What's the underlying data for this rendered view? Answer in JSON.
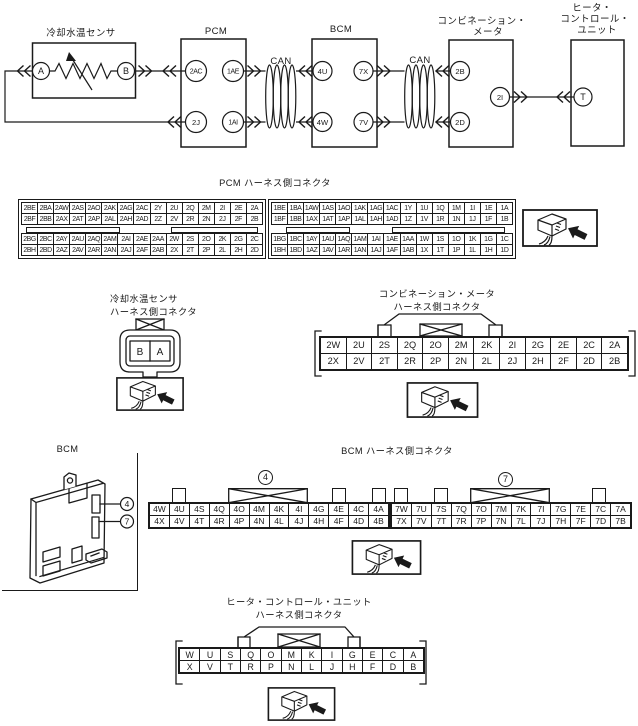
{
  "colors": {
    "ink": "#1a1a1a",
    "paper": "#ffffff"
  },
  "icons": {
    "connector_view": "3d-connector-with-arrow"
  },
  "circuit": {
    "sensor": {
      "title": "冷却水温センサ",
      "term_a": "A",
      "term_b": "B"
    },
    "pcm": {
      "title": "PCM",
      "term_2ac": "2AC",
      "term_1ae": "1AE",
      "term_2j": "2J",
      "term_1ai": "1AI"
    },
    "bcm": {
      "title": "BCM",
      "term_4u": "4U",
      "term_7x": "7X",
      "term_4w": "4W",
      "term_7v": "7V"
    },
    "meter": {
      "title_line1": "コンビネーション・",
      "title_line2": "メータ",
      "term_2b": "2B",
      "term_2d": "2D",
      "term_2i": "2I"
    },
    "heater": {
      "title_line1": "ヒータ・",
      "title_line2": "コントロール・",
      "title_line3": "ユニット",
      "term_t": "T"
    },
    "bus_label_left": "CAN",
    "bus_label_right": "CAN"
  },
  "pcm_connector": {
    "title": "PCM ハーネス側コネクタ",
    "left": {
      "row1": [
        "2BE",
        "2BA",
        "2AW",
        "2AS",
        "2AO",
        "2AK",
        "2AG",
        "2AC",
        "2Y",
        "2U",
        "2Q",
        "2M",
        "2I",
        "2E",
        "2A"
      ],
      "row2": [
        "2BF",
        "2BB",
        "2AX",
        "2AT",
        "2AP",
        "2AL",
        "2AH",
        "2AD",
        "2Z",
        "2V",
        "2R",
        "2N",
        "2J",
        "2F",
        "2B"
      ],
      "row3": [
        "2BG",
        "2BC",
        "2AY",
        "2AU",
        "2AQ",
        "2AM",
        "2AI",
        "2AE",
        "2AA",
        "2W",
        "2S",
        "2O",
        "2K",
        "2G",
        "2C"
      ],
      "row4": [
        "2BH",
        "2BD",
        "2AZ",
        "2AV",
        "2AR",
        "2AN",
        "2AJ",
        "2AF",
        "2AB",
        "2X",
        "2T",
        "2P",
        "2L",
        "2H",
        "2D"
      ]
    },
    "right": {
      "row1": [
        "1BE",
        "1BA",
        "1AW",
        "1AS",
        "1AO",
        "1AK",
        "1AG",
        "1AC",
        "1Y",
        "1U",
        "1Q",
        "1M",
        "1I",
        "1E",
        "1A"
      ],
      "row2": [
        "1BF",
        "1BB",
        "1AX",
        "1AT",
        "1AP",
        "1AL",
        "1AH",
        "1AD",
        "1Z",
        "1V",
        "1R",
        "1N",
        "1J",
        "1F",
        "1B"
      ],
      "row3": [
        "1BG",
        "1BC",
        "1AY",
        "1AU",
        "1AQ",
        "1AM",
        "1AI",
        "1AE",
        "1AA",
        "1W",
        "1S",
        "1O",
        "1K",
        "1G",
        "1C"
      ],
      "row4": [
        "1BH",
        "1BD",
        "1AZ",
        "1AV",
        "1AR",
        "1AN",
        "1AJ",
        "1AF",
        "1AB",
        "1X",
        "1T",
        "1P",
        "1L",
        "1H",
        "1D"
      ]
    }
  },
  "sensor_connector": {
    "title_line1": "冷却水温センサ",
    "title_line2": "ハーネス側コネクタ",
    "pin_left": "B",
    "pin_right": "A"
  },
  "meter_connector": {
    "title_line1": "コンビネーション・メータ",
    "title_line2": "ハーネス側コネクタ",
    "row1": [
      "2W",
      "2U",
      "2S",
      "2Q",
      "2O",
      "2M",
      "2K",
      "2I",
      "2G",
      "2E",
      "2C",
      "2A"
    ],
    "row2": [
      "2X",
      "2V",
      "2T",
      "2R",
      "2P",
      "2N",
      "2L",
      "2J",
      "2H",
      "2F",
      "2D",
      "2B"
    ]
  },
  "bcm_module": {
    "title": "BCM",
    "callout_top": "4",
    "callout_bottom": "7"
  },
  "bcm_connector": {
    "title": "BCM ハーネス側コネクタ",
    "label_left": "4",
    "label_right": "7",
    "left": {
      "row1": [
        "4W",
        "4U",
        "4S",
        "4Q",
        "4O",
        "4M",
        "4K",
        "4I",
        "4G",
        "4E",
        "4C",
        "4A"
      ],
      "row2": [
        "4X",
        "4V",
        "4T",
        "4R",
        "4P",
        "4N",
        "4L",
        "4J",
        "4H",
        "4F",
        "4D",
        "4B"
      ]
    },
    "right": {
      "row1": [
        "7W",
        "7U",
        "7S",
        "7Q",
        "7O",
        "7M",
        "7K",
        "7I",
        "7G",
        "7E",
        "7C",
        "7A"
      ],
      "row2": [
        "7X",
        "7V",
        "7T",
        "7R",
        "7P",
        "7N",
        "7L",
        "7J",
        "7H",
        "7F",
        "7D",
        "7B"
      ]
    }
  },
  "heater_connector": {
    "title_line1": "ヒータ・コントロール・ユニット",
    "title_line2": "ハーネス側コネクタ",
    "row1": [
      "W",
      "U",
      "S",
      "Q",
      "O",
      "M",
      "K",
      "I",
      "G",
      "E",
      "C",
      "A"
    ],
    "row2": [
      "X",
      "V",
      "T",
      "R",
      "P",
      "N",
      "L",
      "J",
      "H",
      "F",
      "D",
      "B"
    ]
  }
}
